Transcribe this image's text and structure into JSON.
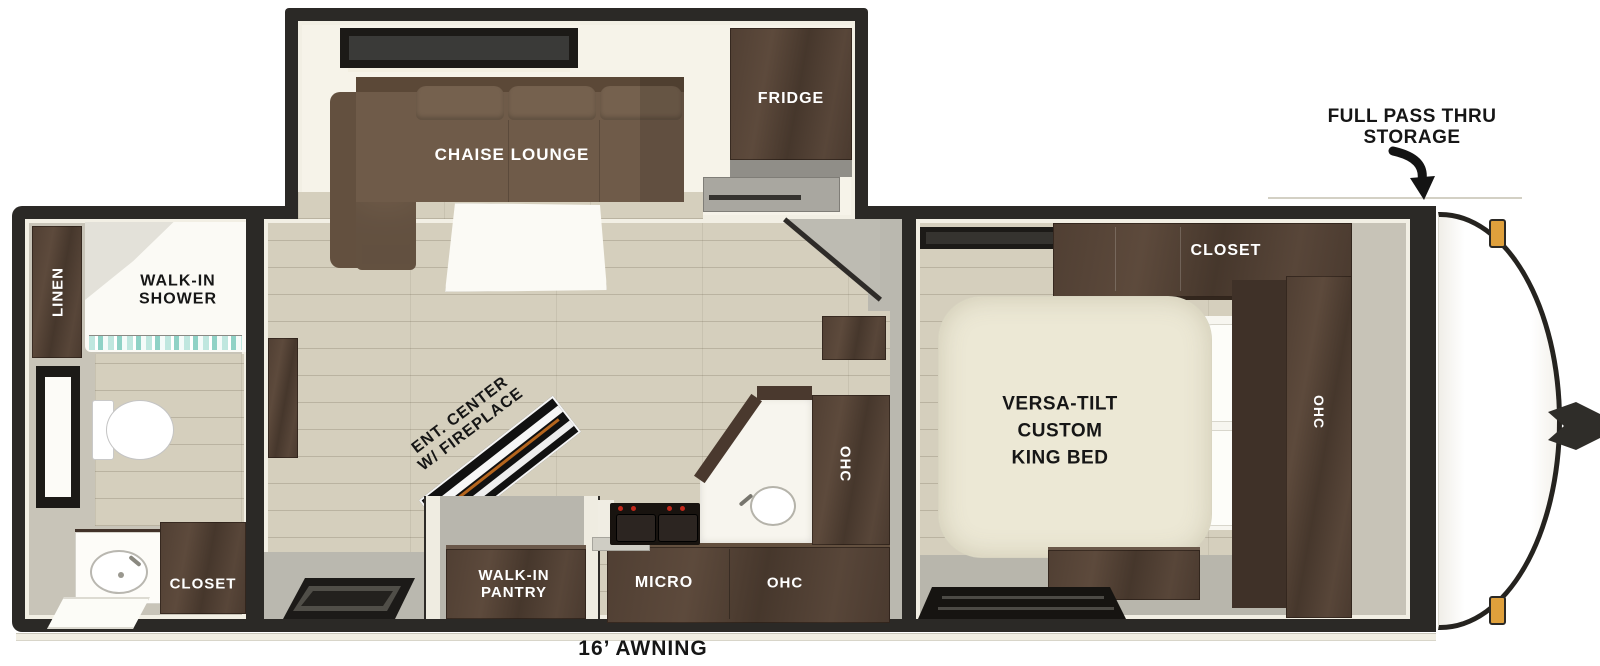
{
  "title": "Travel trailer floor plan",
  "chart_type": "floorplan",
  "colors": {
    "outline": "#2b2926",
    "floor_wood": "#d5cfbd",
    "wall_ivory": "#f2efe4",
    "cabinet_wood": "#503f33",
    "sofa_brown": "#6e5a48",
    "bed_cream": "#ece8d5",
    "entry_gray": "#bab8af",
    "burner_red": "#c2281a",
    "clearance_amber": "#dfa03c",
    "shower_glass_teal": "#8fd2c6"
  },
  "labels": {
    "linen": "LINEN",
    "walk_in_shower": "WALK-IN\nSHOWER",
    "bath_closet": "CLOSET",
    "chaise_lounge": "CHAISE LOUNGE",
    "fridge": "FRIDGE",
    "ent_center": "ENT. CENTER\nW/ FIREPLACE",
    "walk_in_pantry": "WALK-IN\nPANTRY",
    "micro": "MICRO",
    "ohc_kitchen": "OHC",
    "ohc_kitchen_tall": "OHC",
    "bed": "VERSA-TILT\nCUSTOM\nKING BED",
    "bed_closet": "CLOSET",
    "ohc_bedroom": "OHC",
    "full_pass_thru": "FULL PASS THRU\nSTORAGE",
    "awning": "16’ AWNING"
  }
}
